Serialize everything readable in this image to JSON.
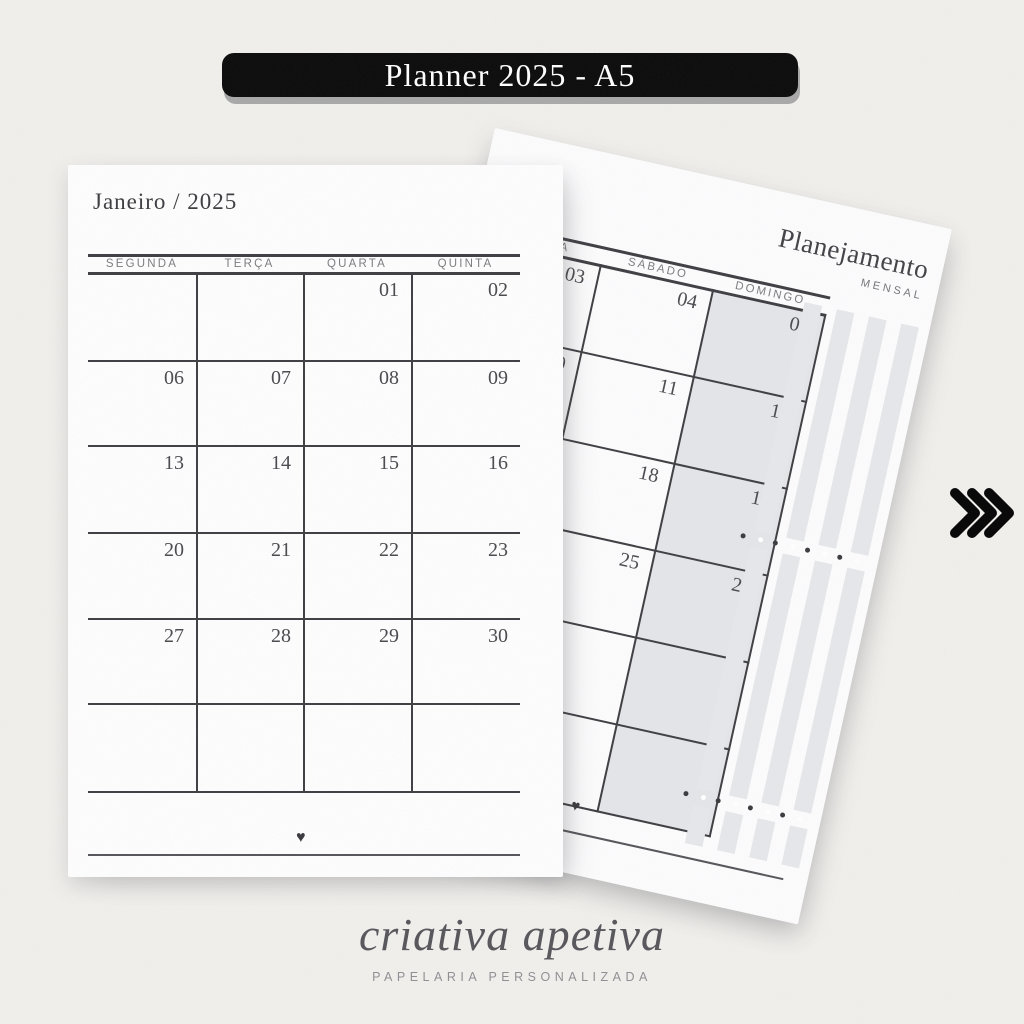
{
  "banner": {
    "label": "Planner 2025 - A5"
  },
  "left_page": {
    "title": "Janeiro / 2025",
    "day_headers": [
      "SEGUNDA",
      "TERÇA",
      "QUARTA",
      "QUINTA"
    ],
    "weeks": [
      [
        "",
        "",
        "01",
        "02"
      ],
      [
        "06",
        "07",
        "08",
        "09"
      ],
      [
        "13",
        "14",
        "15",
        "16"
      ],
      [
        "20",
        "21",
        "22",
        "23"
      ],
      [
        "27",
        "28",
        "29",
        "30"
      ],
      [
        "",
        "",
        "",
        ""
      ]
    ],
    "heart": "♥"
  },
  "right_page": {
    "title": "Planejamento",
    "subtitle": "MENSAL",
    "day_headers": [
      "SEXTA",
      "SÁBADO",
      "DOMINGO"
    ],
    "weeks": [
      [
        "03",
        "04",
        "05"
      ],
      [
        "10",
        "11",
        "12"
      ],
      [
        "17",
        "18",
        "19"
      ],
      [
        "24",
        "25",
        "26"
      ],
      [
        "31",
        "",
        ""
      ],
      [
        "",
        "",
        ""
      ]
    ],
    "heart": "♥"
  },
  "pagination_arrow": {
    "icon": "triple-chevron-right"
  },
  "footer": {
    "brand": "criativa apetiva",
    "tagline": "PAPELARIA PERSONALIZADA"
  },
  "colors": {
    "background": "#f0efec",
    "banner_bg": "#0b0b0b",
    "banner_text": "#ffffff",
    "page": "#fdfdfd",
    "grid_line": "#3e3e43",
    "date_text": "#4a4a4f",
    "header_text": "#7c7c80",
    "weekend_fill": "#e4e5e8",
    "washi_bar": "#e6e7ea",
    "brand_text": "#56565b"
  }
}
